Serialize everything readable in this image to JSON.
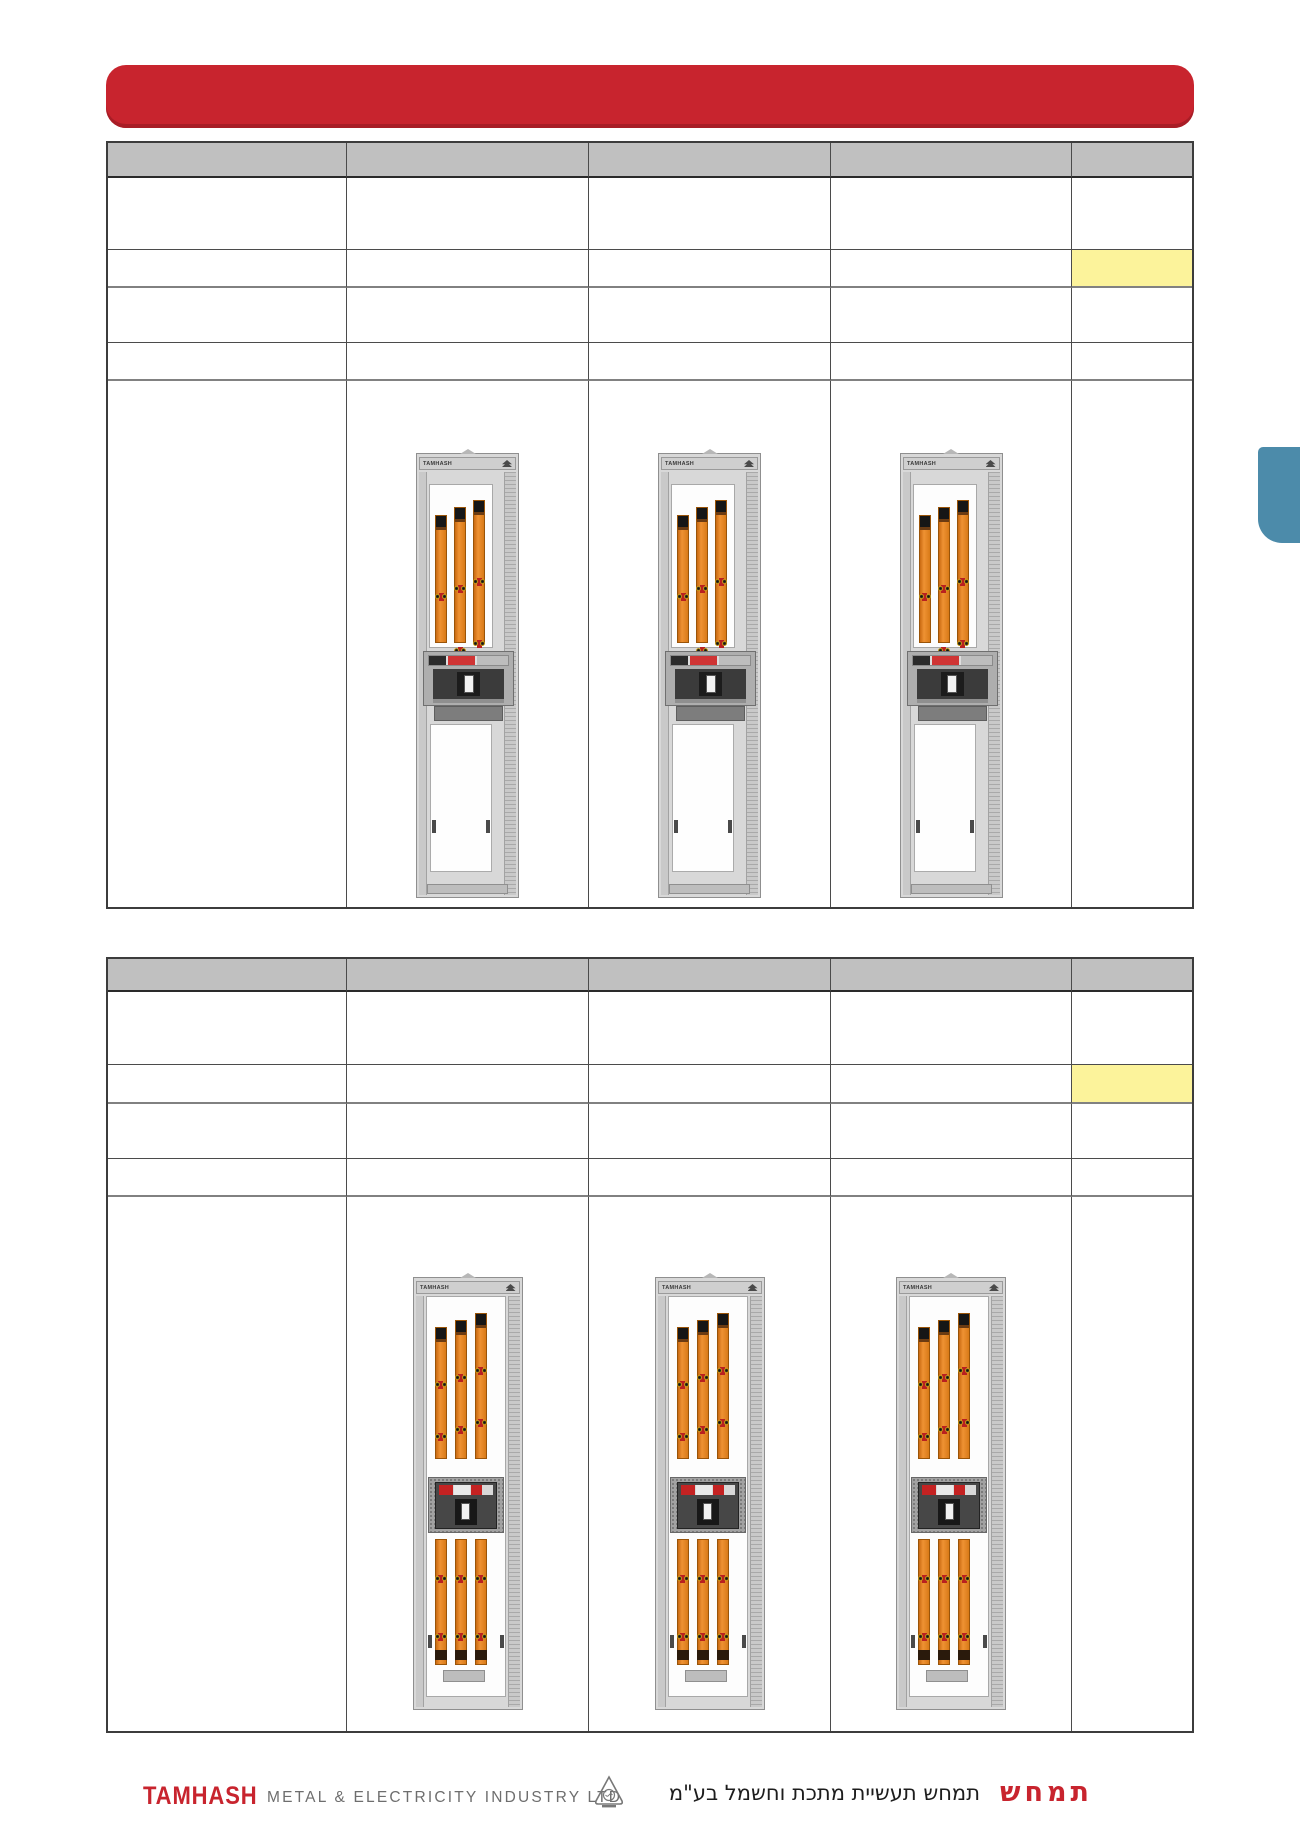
{
  "banner": {
    "color": "#c8242e"
  },
  "side_tab": {
    "color": "#4c8baa"
  },
  "tables": {
    "upper": {
      "columns": 5,
      "rows": 6,
      "header_bg": "#c0c0c0",
      "highlighted_cell": {
        "row": 3,
        "column": 5,
        "color": "#FCF39B"
      },
      "cabinet_images": 3
    },
    "lower": {
      "columns": 5,
      "rows": 6,
      "header_bg": "#c0c0c0",
      "highlighted_cell": {
        "row": 3,
        "column": 5,
        "color": "#FCF39B"
      },
      "cabinet_images": 3
    }
  },
  "cabinet": {
    "brand_label": "TAMHASH"
  },
  "footer": {
    "logo_text": "TAMHASH",
    "company_text": "METAL & ELECTRICITY INDUSTRY LTD",
    "hebrew_text": "תמחש תעשיית מתכת וחשמל בע\"מ",
    "hebrew_logo": "תמחש"
  }
}
